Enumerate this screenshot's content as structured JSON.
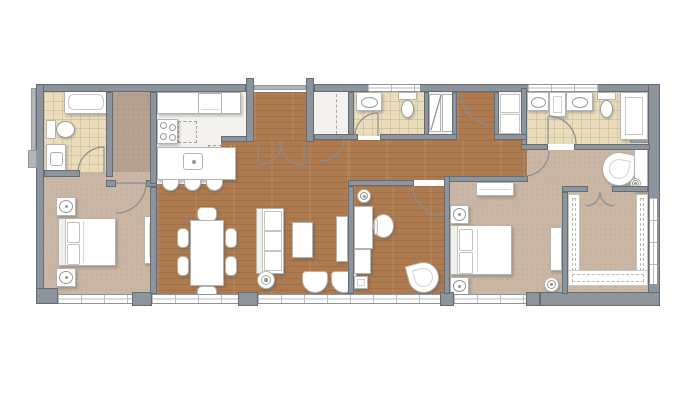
{
  "title": "apartment-floor-plan",
  "palette": {
    "bg": "#ffffff",
    "wall": "#8e949b",
    "wall_dark": "#686e75",
    "wall_light": "#b2b6ba",
    "wood": "#ae7a4f",
    "carpet": "#cab6a4",
    "hall_carpet": "#b7a190",
    "tile": "#e9ddbb",
    "white_floor": "#f3f2ef",
    "furn": "#ffffff",
    "furn_line": "#b4b4ae",
    "door_arc": "#888e93",
    "glass_line": "#b7bcc1"
  },
  "rooms": [
    {
      "id": "bathroom-1",
      "floor": "tile",
      "fixtures": [
        "bathtub",
        "toilet",
        "vanity-sink",
        "swing-door"
      ]
    },
    {
      "id": "hall-1",
      "floor": "carpet",
      "fixtures": [
        "closet-shelf-dashed"
      ]
    },
    {
      "id": "bedroom-1",
      "floor": "carpet",
      "fixtures": [
        "double-bed",
        "nightstand-lamp",
        "nightstand-lamp",
        "wardrobe",
        "window"
      ]
    },
    {
      "id": "kitchen",
      "floor": "hard-floor",
      "fixtures": [
        "counter",
        "oven",
        "cooktop-4-burner",
        "island",
        "island-sink",
        "dishwasher-dashed",
        "upper-cabinet-dashed",
        "bar-stool",
        "bar-stool",
        "bar-stool",
        "pantry-closet"
      ]
    },
    {
      "id": "dining-area",
      "floor": "wood",
      "fixtures": [
        "dining-table",
        "chair",
        "chair",
        "chair",
        "chair",
        "chair",
        "chair"
      ]
    },
    {
      "id": "living-room",
      "floor": "wood",
      "fixtures": [
        "sofa",
        "coffee-table",
        "armchair",
        "armchair",
        "floor-lamp",
        "tv-console",
        "window"
      ]
    },
    {
      "id": "entry-foyer",
      "floor": "wood",
      "fixtures": [
        "double-entry-doors"
      ]
    },
    {
      "id": "coat-closet",
      "floor": "hard-floor",
      "fixtures": [
        "rod-dashed",
        "swing-door"
      ]
    },
    {
      "id": "powder-room",
      "floor": "tile",
      "fixtures": [
        "counter-sink",
        "toilet",
        "swing-door"
      ]
    },
    {
      "id": "laundry-closet",
      "floor": "hard-floor",
      "fixtures": [
        "stacked-unit",
        "stacked-unit"
      ]
    },
    {
      "id": "vestibule",
      "floor": "wood",
      "fixtures": [
        "swing-door"
      ]
    },
    {
      "id": "linen-closet",
      "floor": "hard-floor",
      "fixtures": [
        "shelf",
        "shelf"
      ]
    },
    {
      "id": "hallway",
      "floor": "wood",
      "fixtures": []
    },
    {
      "id": "den-office",
      "floor": "wood",
      "fixtures": [
        "floor-lamp",
        "desk",
        "task-chair",
        "return-cabinet",
        "printer-stand",
        "lounge-chair",
        "swing-door",
        "window"
      ]
    },
    {
      "id": "master-bedroom",
      "floor": "carpet",
      "fixtures": [
        "dresser",
        "double-bed",
        "nightstand-lamp",
        "nightstand-lamp",
        "tv-console",
        "round-side-table",
        "lounge-chair",
        "tall-cabinet",
        "table-lamp",
        "window"
      ]
    },
    {
      "id": "master-bathroom",
      "floor": "tile",
      "fixtures": [
        "vanity-sink",
        "center-cabinet",
        "vanity-sink",
        "toilet",
        "shower",
        "swing-door",
        "window"
      ]
    },
    {
      "id": "walk-in-closet",
      "floor": "carpet",
      "fixtures": [
        "shelving-u-left",
        "shelving-u-bottom",
        "shelving-u-right",
        "double-doors"
      ]
    }
  ],
  "windows": {
    "bottom_sections": 4,
    "right_sections": 1,
    "top_sections": 2
  },
  "doors": {
    "swing_doors": 9,
    "double_door_sets": 2
  }
}
